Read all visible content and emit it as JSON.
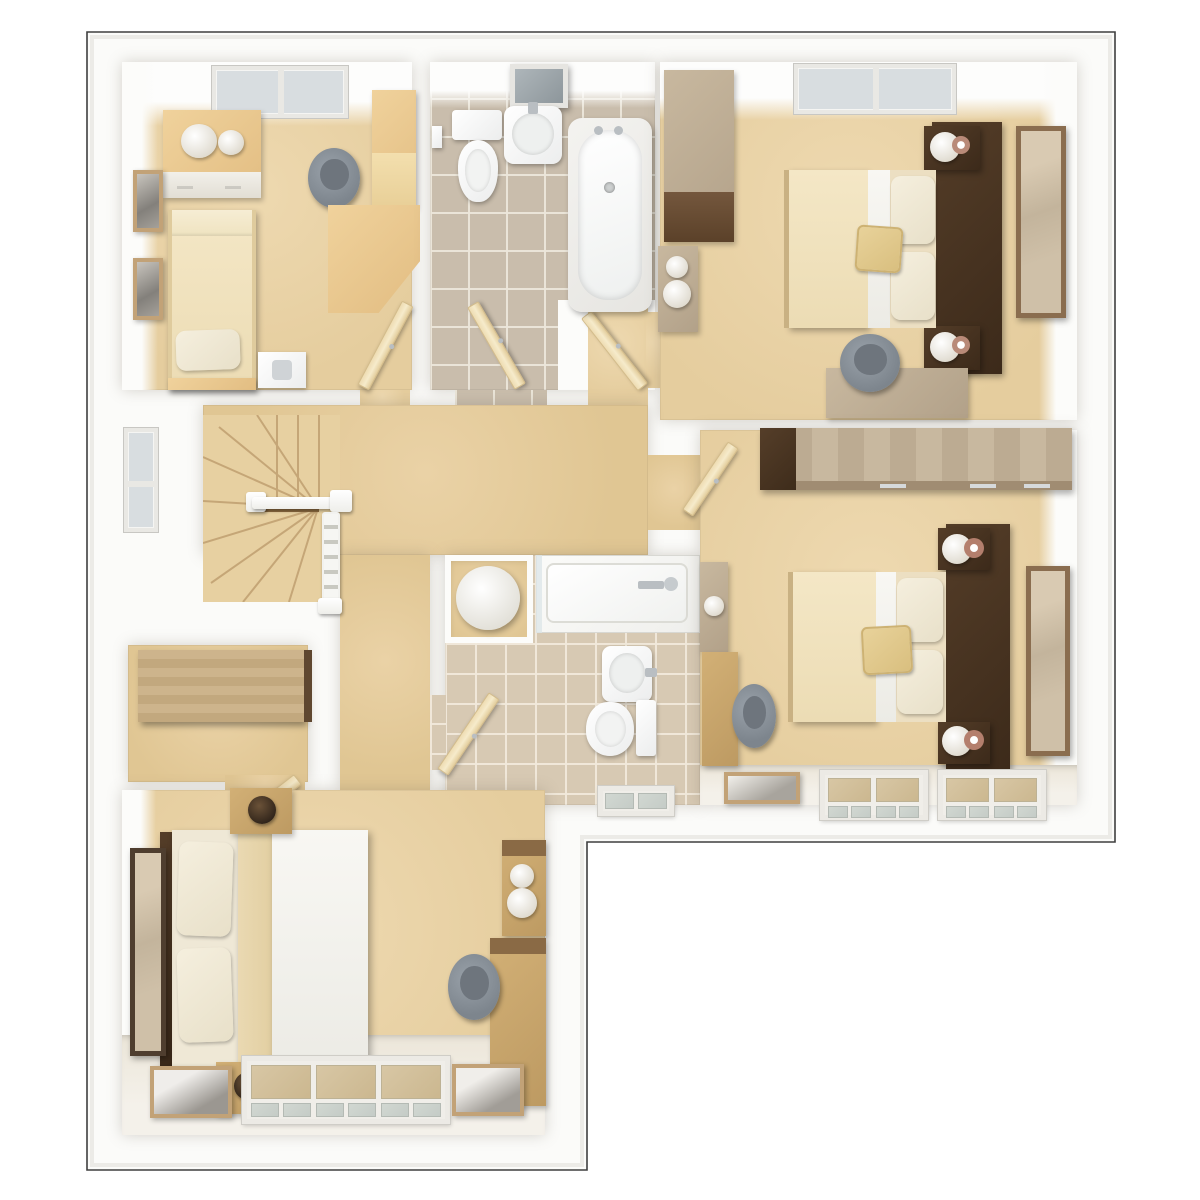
{
  "meta": {
    "title": "3D top-down floor plan render — upper floor with four bedrooms, family bathroom, en-suite shower room, airing cupboard and winder staircase landing",
    "view": "dollhouse top-down 3D render",
    "building_shape": "L-shaped footprint, bottom-right corner cut away"
  },
  "palette": {
    "page_background": "#ffffff",
    "plate_white": "#fcfcfa",
    "outline": "#3f3f3f",
    "wall": "#ffffff",
    "carpet": "#e8d2a6",
    "bathroom_tile": "#c9bdac",
    "bathroom_grout": "#ece6da",
    "ensuite_tile": "#d7c9b3",
    "wood_light_pine": "#eccb94",
    "wood_grey_brown": "#bfae96",
    "wood_oak": "#c9a873",
    "walnut_dark": "#46311f",
    "fabric_cream": "#f2e4bf",
    "fabric_white": "#f6f4ef",
    "cushion_gold": "#e0c78d",
    "chair_grey": "#8b939b",
    "window_glass_wall": "#d8dde0",
    "window_glass_floor": "#cfd5cf",
    "metal": "#b9bec2"
  },
  "rooms": [
    {
      "id": "bedroom-top-left",
      "kind": "bedroom",
      "furniture": [
        "top-wall window",
        "chest of drawers with two table lamps",
        "two framed wall pictures",
        "single bed with pillow",
        "bedside table",
        "grey desk chair",
        "tall cabinet",
        "corner desk",
        "door"
      ]
    },
    {
      "id": "family-bathroom",
      "kind": "bathroom",
      "furniture": [
        "wall mirror",
        "toilet with cistern",
        "toilet-roll holder",
        "wall basin with tap",
        "bathtub with taps",
        "grey tiled floor",
        "door"
      ]
    },
    {
      "id": "bedroom-top-right",
      "kind": "bedroom",
      "furniture": [
        "top-wall window",
        "double wardrobe",
        "dresser with lamp",
        "double bed with cream duvet and gold cushion",
        "dark headboard panel",
        "two bedside tables with lamps",
        "wall mirror",
        "desk",
        "grey desk chair",
        "door"
      ]
    },
    {
      "id": "landing",
      "kind": "hallway",
      "furniture": [
        "winder staircase",
        "white balustrade with newel posts",
        "side-wall window"
      ]
    },
    {
      "id": "airing-cupboard",
      "kind": "storage",
      "furniture": [
        "wooden worktop shelf"
      ]
    },
    {
      "id": "ensuite-shower-room",
      "kind": "bathroom",
      "furniture": [
        "hot-water cylinder in cupboard",
        "shower enclosure with fittings",
        "wash basin",
        "toilet with cistern",
        "beige tiled floor",
        "bottom-wall window",
        "door"
      ]
    },
    {
      "id": "bedroom-middle-right",
      "kind": "bedroom",
      "furniture": [
        "fitted wardrobe along top wall",
        "double bed with cream duvet and gold cushion",
        "dark headboard panel",
        "two bedside tables with lamps and flowers",
        "wall mirror",
        "two side cabinets",
        "grey desk chair",
        "picture frame",
        "two bottom-wall windows",
        "door"
      ]
    },
    {
      "id": "bedroom-bottom-left",
      "kind": "bedroom",
      "furniture": [
        "double bed with stacked pillows",
        "two oak bedside cabinets with dark lamps",
        "tall wall mirror",
        "dresser with lamp",
        "desk unit",
        "grey desk chair",
        "triple bottom-wall window",
        "two framed pictures",
        "door"
      ]
    }
  ],
  "counts": {
    "bedrooms": 4,
    "bathrooms": 2,
    "windows": 7,
    "doors": 7,
    "staircases": 1
  }
}
